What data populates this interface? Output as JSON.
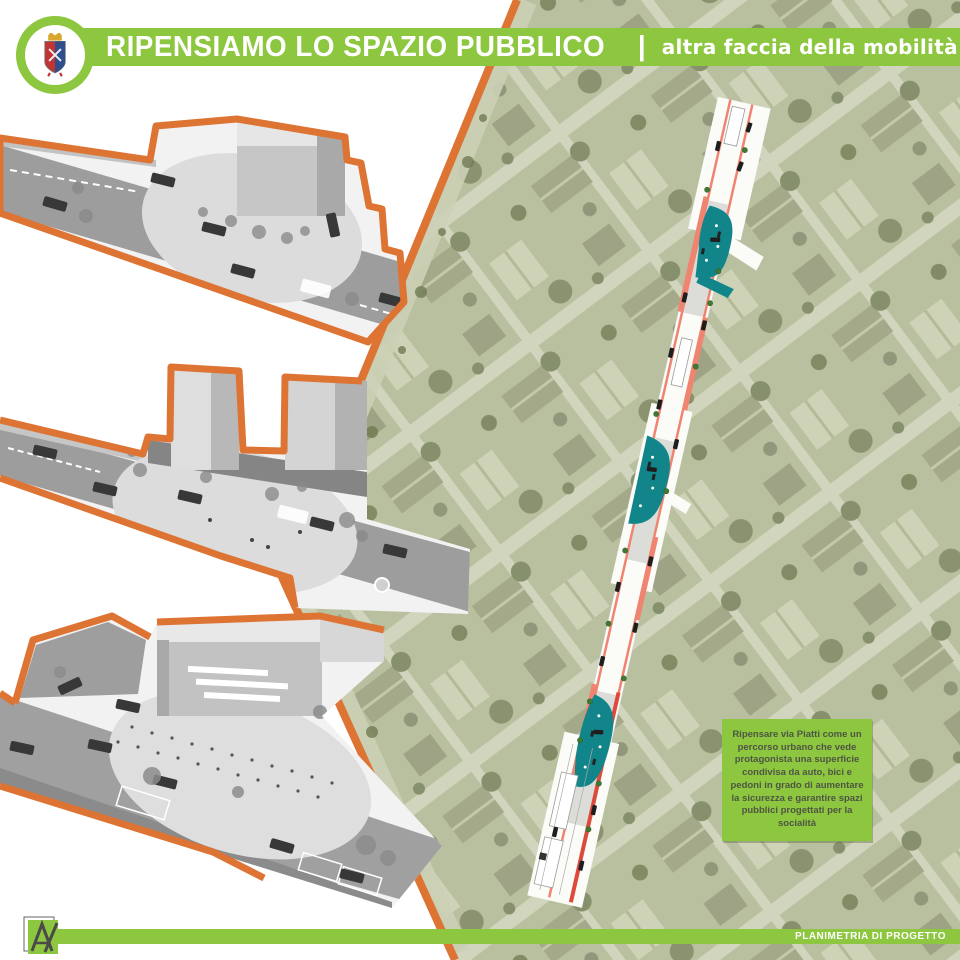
{
  "header": {
    "title": "RIPENSIAMO LO SPAZIO PUBBLICO",
    "divider": "|",
    "subtitle": "altra faccia della mobilità",
    "logo": "municipal-coat-of-arms"
  },
  "note": {
    "text": "Ripensare via Piatti come un percorso urbano che vede protagonista una superficie condivisa da auto, bici e pedoni in grado di aumentare la sicurezza e garantire spazi pubblici progettati per la socialità"
  },
  "footer": {
    "label": "PLANIMETRIA DI PROGETTO",
    "logo_monogram": "A"
  },
  "colors": {
    "brand_green": "#8dc63f",
    "accent_orange": "#dd7434",
    "plan_teal": "#11858a",
    "plan_salmon": "#ef8570",
    "plan_red": "#dd4a3c"
  }
}
